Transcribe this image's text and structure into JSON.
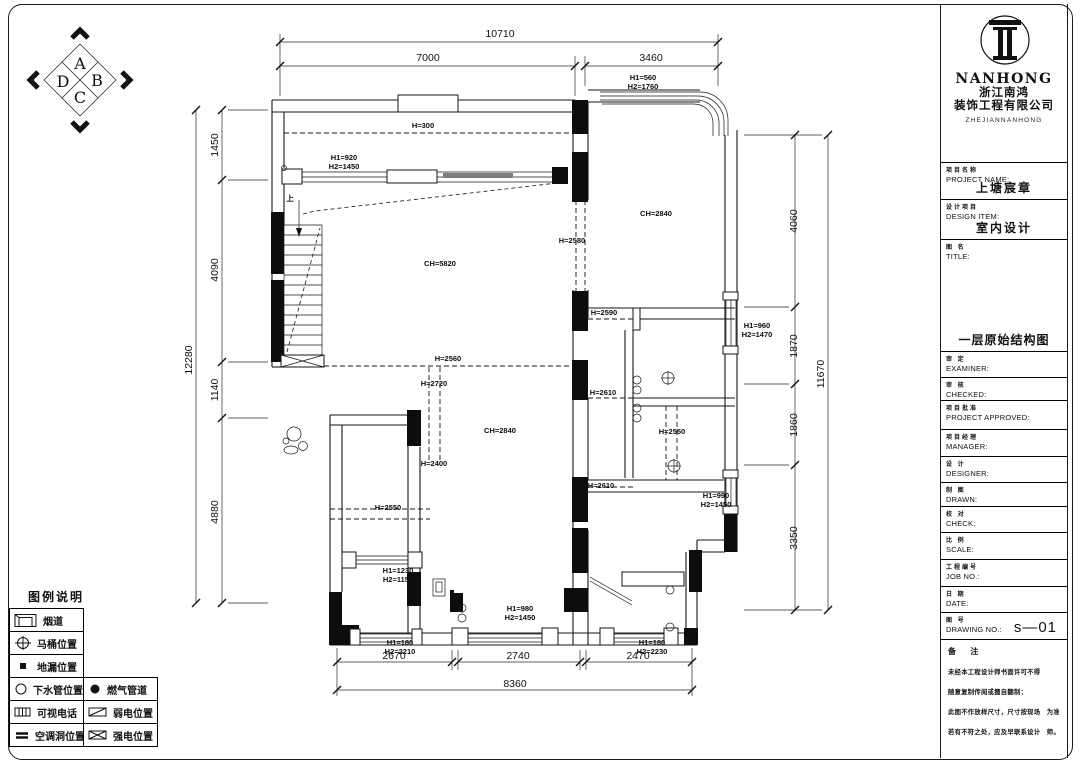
{
  "colors": {
    "line": "#161616",
    "background": "#ffffff",
    "window_shade": "#7d7d7d"
  },
  "compass": {
    "letters": [
      {
        "t": "A",
        "x": 80,
        "y": 69
      },
      {
        "t": "B",
        "x": 97,
        "y": 86
      },
      {
        "t": "C",
        "x": 80,
        "y": 103
      },
      {
        "t": "D",
        "x": 63,
        "y": 87
      }
    ]
  },
  "dimensions": {
    "top": [
      {
        "t": "10710",
        "x": 500,
        "y": 37
      },
      {
        "t": "7000",
        "x": 428,
        "y": 61
      },
      {
        "t": "3460",
        "x": 651,
        "y": 61
      }
    ],
    "left": [
      {
        "t": "12280",
        "x": 192,
        "y": 360,
        "rot": true
      },
      {
        "t": "1450",
        "x": 218,
        "y": 145,
        "rot": true
      },
      {
        "t": "4090",
        "x": 218,
        "y": 270,
        "rot": true
      },
      {
        "t": "1140",
        "x": 218,
        "y": 390,
        "rot": true
      },
      {
        "t": "4880",
        "x": 218,
        "y": 512,
        "rot": true
      }
    ],
    "right": [
      {
        "t": "11670",
        "x": 824,
        "y": 374,
        "rot": true
      },
      {
        "t": "4060",
        "x": 797,
        "y": 221,
        "rot": true
      },
      {
        "t": "1870",
        "x": 797,
        "y": 346,
        "rot": true
      },
      {
        "t": "1860",
        "x": 797,
        "y": 425,
        "rot": true
      },
      {
        "t": "3350",
        "x": 797,
        "y": 538,
        "rot": true
      }
    ],
    "bottom": [
      {
        "t": "2670",
        "x": 394,
        "y": 659
      },
      {
        "t": "2740",
        "x": 518,
        "y": 659
      },
      {
        "t": "2470",
        "x": 638,
        "y": 659
      },
      {
        "t": "8360",
        "x": 515,
        "y": 687
      }
    ]
  },
  "plan": {
    "labels": [
      {
        "t": "H=300",
        "x": 423,
        "y": 128
      },
      {
        "t": "H1=920",
        "x": 344,
        "y": 160
      },
      {
        "t": "H2=1450",
        "x": 344,
        "y": 169
      },
      {
        "t": "上",
        "x": 290,
        "y": 201,
        "s": 10
      },
      {
        "t": "CH=5820",
        "x": 440,
        "y": 266
      },
      {
        "t": "H=2560",
        "x": 448,
        "y": 361
      },
      {
        "t": "H=2580",
        "x": 572,
        "y": 243
      },
      {
        "t": "CH=2840",
        "x": 656,
        "y": 216
      },
      {
        "t": "H1=560",
        "x": 643,
        "y": 80
      },
      {
        "t": "H2=1760",
        "x": 643,
        "y": 89
      },
      {
        "t": "H1=960",
        "x": 757,
        "y": 328
      },
      {
        "t": "H2=1470",
        "x": 757,
        "y": 337
      },
      {
        "t": "H=2590",
        "x": 604,
        "y": 315
      },
      {
        "t": "H=2720",
        "x": 434,
        "y": 386
      },
      {
        "t": "H=2400",
        "x": 434,
        "y": 466
      },
      {
        "t": "CH=2840",
        "x": 500,
        "y": 433
      },
      {
        "t": "H=2610",
        "x": 603,
        "y": 395
      },
      {
        "t": "H=2550",
        "x": 672,
        "y": 434
      },
      {
        "t": "H=2610",
        "x": 601,
        "y": 488
      },
      {
        "t": "H1=990",
        "x": 716,
        "y": 498
      },
      {
        "t": "H2=1450",
        "x": 716,
        "y": 507
      },
      {
        "t": "H=2550",
        "x": 388,
        "y": 510
      },
      {
        "t": "H1=1230",
        "x": 398,
        "y": 573
      },
      {
        "t": "H2=1150",
        "x": 398,
        "y": 582
      },
      {
        "t": "H1=980",
        "x": 520,
        "y": 611
      },
      {
        "t": "H2=1450",
        "x": 520,
        "y": 620
      },
      {
        "t": "H1=180",
        "x": 400,
        "y": 645
      },
      {
        "t": "H2=2210",
        "x": 400,
        "y": 654
      },
      {
        "t": "H1=180",
        "x": 652,
        "y": 645
      },
      {
        "t": "H2=2230",
        "x": 652,
        "y": 654
      }
    ]
  },
  "legend": {
    "title": "图例说明",
    "rows": [
      {
        "cells": [
          {
            "icon": "flue",
            "label": "烟道"
          }
        ]
      },
      {
        "cells": [
          {
            "icon": "toilet",
            "label": "马桶位置"
          }
        ]
      },
      {
        "cells": [
          {
            "icon": "floor-drain",
            "label": "地漏位置"
          }
        ]
      },
      {
        "cells": [
          {
            "icon": "drain-pipe",
            "label": "下水管位置"
          },
          {
            "icon": "gas-pipe",
            "label": "燃气管道"
          }
        ]
      },
      {
        "cells": [
          {
            "icon": "video-phone",
            "label": "可视电话"
          },
          {
            "icon": "weak-current",
            "label": "弱电位置"
          }
        ]
      },
      {
        "cells": [
          {
            "icon": "ac-hole",
            "label": "空调洞位置"
          },
          {
            "icon": "strong-current",
            "label": "强电位置"
          }
        ]
      }
    ]
  },
  "title_block": {
    "brand": {
      "name": "NANHONG",
      "company_cn_1": "浙江南鸿",
      "company_cn_2": "装饰工程有限公司",
      "company_en": "ZHEJIANNANHONG"
    },
    "fields": [
      {
        "cn": "项目名称",
        "en": "PROJECT NAME:",
        "value": "上塘宸章"
      },
      {
        "cn": "设计项目",
        "en": "DESIGN ITEM:",
        "value": "室内设计"
      },
      {
        "cn": "图 名",
        "en": "TITLE:",
        "value": "一层原始结构图"
      },
      {
        "cn": "审 定",
        "en": "EXAMINER:",
        "value": ""
      },
      {
        "cn": "审 核",
        "en": "CHECKED:",
        "value": ""
      },
      {
        "cn": "项目批准",
        "en": "PROJECT APPROVED:",
        "value": ""
      },
      {
        "cn": "项目经理",
        "en": "MANAGER:",
        "value": ""
      },
      {
        "cn": "设 计",
        "en": "DESIGNER:",
        "value": ""
      },
      {
        "cn": "制 图",
        "en": "DRAWN:",
        "value": ""
      },
      {
        "cn": "校 对",
        "en": "CHECK:",
        "value": ""
      },
      {
        "cn": "比 例",
        "en": "SCALE:",
        "value": ""
      },
      {
        "cn": "工程编号",
        "en": "JOB NO.:",
        "value": ""
      },
      {
        "cn": "日 期",
        "en": "DATE:",
        "value": ""
      },
      {
        "cn": "图 号",
        "en": "DRAWING NO.:",
        "value": "s—01"
      }
    ],
    "notes": {
      "header": "备 注",
      "lines": [
        {
          "left": "未经本工程设计师书面许可不得",
          "right": ""
        },
        {
          "left": "随意复制传阅或擅自翻制：",
          "right": ""
        },
        {
          "left": "此图不作放样尺寸，尺寸按现场",
          "right": "为准"
        },
        {
          "left": "若有不符之处，应及早联系设计",
          "right": "师。"
        }
      ]
    }
  }
}
